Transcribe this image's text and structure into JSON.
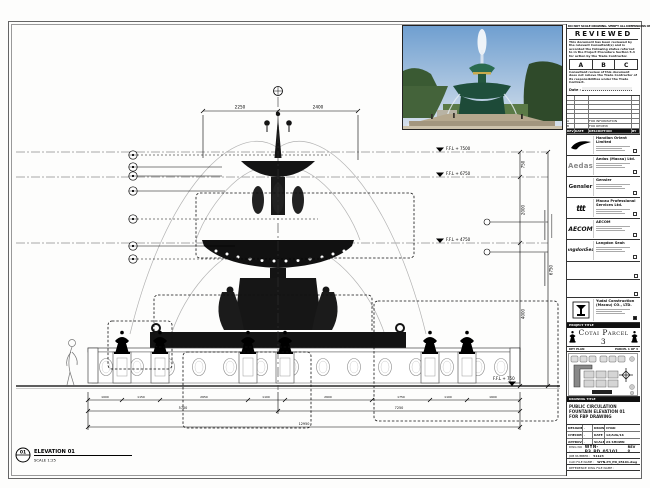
{
  "drawing": {
    "detail_no": "01",
    "elevation_label": "ELEVATION 01",
    "scale_label": "SCALE 1:25",
    "levels": {
      "l1": "F.F.L + 7500",
      "l2": "F.F.L + 6750",
      "l3": "F.F.L + 4750",
      "l4": "F.F.L + 750"
    },
    "dims": {
      "top_left": "2250",
      "top_right": "2400",
      "right_1": "750",
      "right_2": "2000",
      "right_3": "4000",
      "right_total": "6750",
      "bottom_row1": [
        "1000",
        "1150",
        "2650",
        "1100",
        "2600",
        "1750",
        "1100",
        "1600"
      ],
      "bottom_row2_left": "5700",
      "bottom_row2_right": "7250",
      "bottom_total": "12950"
    }
  },
  "photo": {
    "credit": "©"
  },
  "stamp": {
    "top_note": "DO NOT SCALE DRAWING. VERIFY ALL DIMENSIONS ON SITE.",
    "title": "REVIEWED",
    "para1": "This document has been reviewed by the relevant Consultant(s) and is accorded the following status referred to in the Project Procedure Section 5.4 for action by the Trade Contractor.",
    "options": {
      "a": "A",
      "b": "B",
      "c": "C"
    },
    "para2": "Consultant review of this document does not relieve the Trade Contractor of its responsibilities under the Trade Contract.",
    "date_label": "Date :"
  },
  "revisions": {
    "header": {
      "rev": "REV",
      "date": "DATE",
      "desc": "DESCRIPTION",
      "by": "BY"
    },
    "rows": [
      {
        "rev": "A",
        "date": "",
        "desc": "FOR INFORMATION",
        "by": ""
      },
      {
        "rev": "B",
        "date": "",
        "desc": "FOR REVIEW",
        "by": ""
      }
    ]
  },
  "consultants": [
    {
      "logo_text": "",
      "name": "Handian Orient Limited"
    },
    {
      "logo_text": "Aedas",
      "name": "Aedas (Macau) Ltd."
    },
    {
      "logo_text": "Gensler",
      "name": "Gensler"
    },
    {
      "logo_text": "ttt",
      "name": "Macau Professional Services Ltd."
    },
    {
      "logo_text": "AECOM",
      "name": "AECOM"
    },
    {
      "logo_text": "LangdonSeah",
      "name": "Langdon Seah"
    }
  ],
  "contractor": {
    "name": "Yudai Construction (Macau) CO., LTD."
  },
  "project": {
    "label": "PROJECT TITLE",
    "name": "Cotai Parcel 3"
  },
  "key_plan": {
    "label": "KEY PLAN",
    "note": "PARCEL 1 OF 3"
  },
  "title_box": {
    "label": "DRAWING TITLE",
    "line1": "PUBLIC CIRCULATION",
    "line2": "FOUNTAIN ELEVATION 01",
    "line3": "FOR FBP DRAWING"
  },
  "credits": {
    "designed_label": "DESIGNED",
    "designed": "-",
    "drawn_label": "DRAWN",
    "drawn": "CHAD",
    "checked_label": "CHECKED",
    "checked": "-",
    "date_label": "DATE",
    "date": "12/AUG/16",
    "approved_label": "APPROVED",
    "approved": "-",
    "scale_label": "SCALE",
    "scale": "AS SHOWN"
  },
  "numbers": {
    "dwg_label": "DWG NO :",
    "dwg": "WYN-P3_PD_05101",
    "rev": "REV 0",
    "job_label": "JOB NUMBER :",
    "job": "51123",
    "cad_label": "CAD FILE NAME :",
    "cad": "WYN-P3_PD_05101.dwg",
    "ref_label": "REFERENCE DWG FILE NAME :"
  }
}
